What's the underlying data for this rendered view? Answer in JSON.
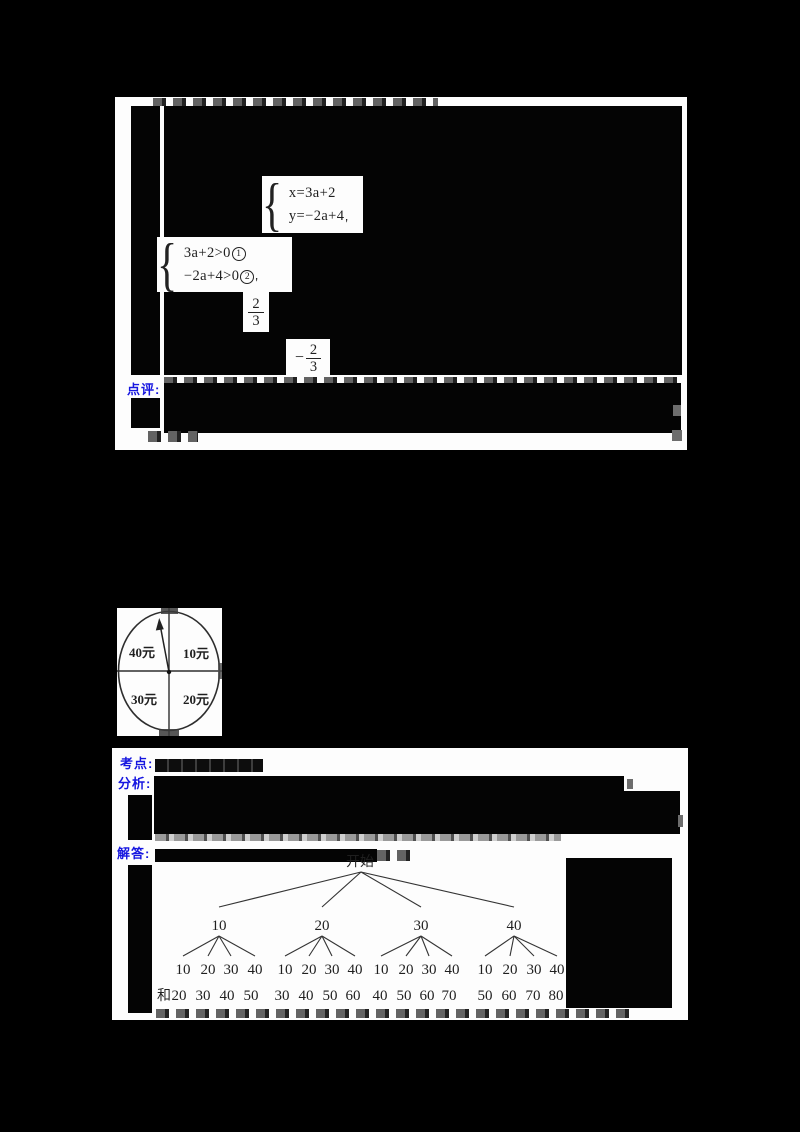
{
  "document": {
    "background": "#000000",
    "block1": {
      "comment_label": "点评:",
      "system1": {
        "line1": "x=3a+2",
        "line2": "y=−2a+4",
        "suffix": "'"
      },
      "system2": {
        "line1": "3a+2>0",
        "mark1": "1",
        "line2": "−2a+4>0",
        "mark2": "2",
        "suffix": "'"
      },
      "fraction1": {
        "sign": "",
        "numerator": "2",
        "denominator": "3"
      },
      "fraction2": {
        "sign": "−",
        "numerator": "2",
        "denominator": "3"
      }
    },
    "spinner": {
      "top_left": "40元",
      "top_right": "10元",
      "bottom_left": "30元",
      "bottom_right": "20元"
    },
    "block3": {
      "kaodian_label": "考点:",
      "fenxi_label": "分析:",
      "jieda_label": "解答:",
      "tree": {
        "root": "开始",
        "level1": [
          "10",
          "20",
          "30",
          "40"
        ],
        "leaves": [
          [
            "10",
            "20",
            "30",
            "40"
          ],
          [
            "10",
            "20",
            "30",
            "40"
          ],
          [
            "10",
            "20",
            "30",
            "40"
          ],
          [
            "10",
            "20",
            "30",
            "40"
          ]
        ],
        "sum_label": "和",
        "sums": [
          [
            "20",
            "30",
            "40",
            "50"
          ],
          [
            "30",
            "40",
            "50",
            "60"
          ],
          [
            "40",
            "50",
            "60",
            "70"
          ],
          [
            "50",
            "60",
            "70",
            "80"
          ]
        ]
      }
    },
    "colors": {
      "label_blue": "#1616e0",
      "ink": "#1f1f1f"
    }
  }
}
